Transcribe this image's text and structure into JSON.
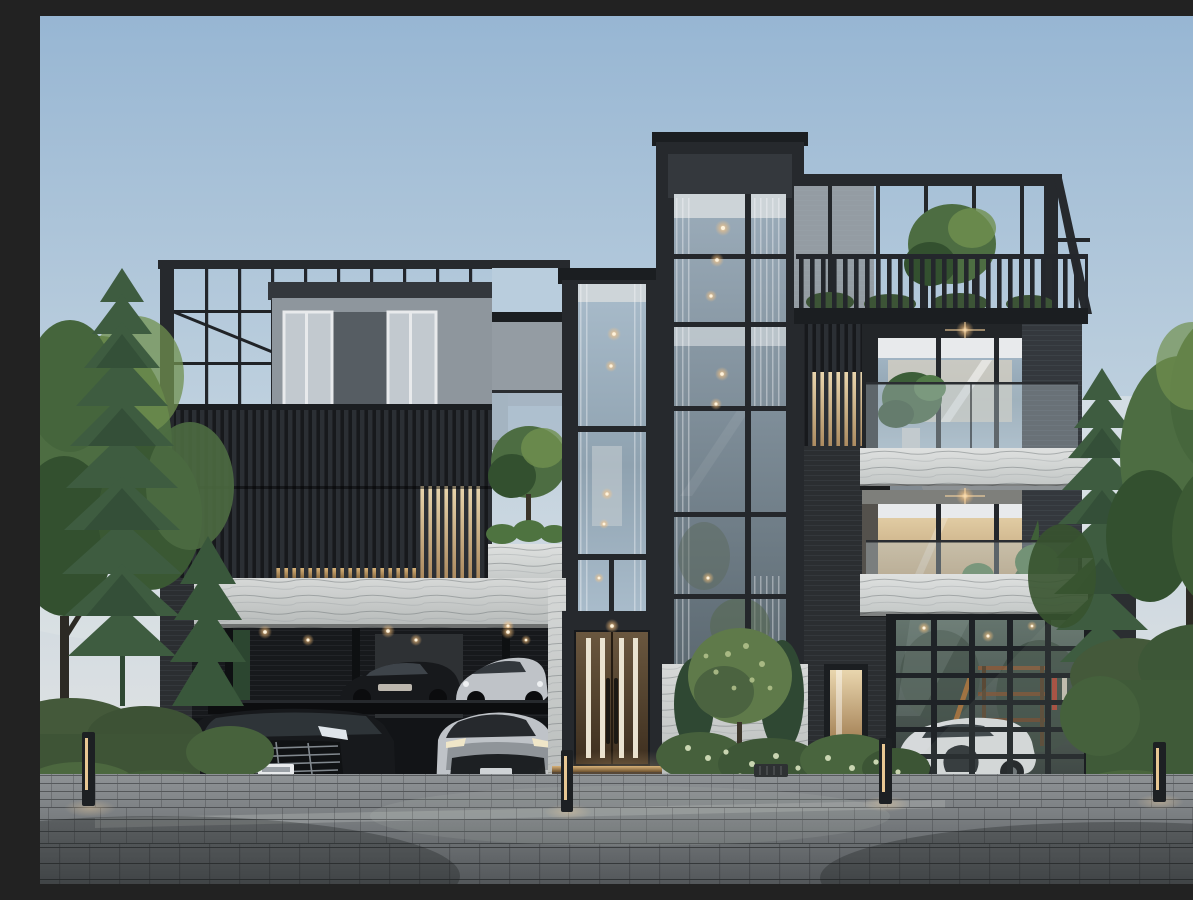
{
  "scene": {
    "type": "photorealistic architectural exterior rendering",
    "subject": "modern four-storey luxury residence at dusk",
    "time_of_day": "dusk",
    "description": "Dusk rendering of a modern charcoal and white-stone luxury townhouse: vertical-louver screen facade with rooftop railing terrace over a grey penthouse volume, a full-height glazed stair tower with warm recessed lights, a rooftop pergola terrace with tree and picket railing, two recessed balconies with glass balustrades, marble parapets and potted plants, a two-level car-lift carport holding four luxury vehicles, a glass sectional garage door revealing a white supercar, a timber double entry door with lit stone steps, clipped hedges, pines and flowering shrubs, warm bollard lights and a grey block-paved driveway."
  },
  "palette": {
    "sky_top": "#97b6d3",
    "sky_mid": "#bed0de",
    "sky_low": "#dadfe2",
    "sky_haze": "#e9ebe9",
    "frame": "#26292d",
    "frame_dark": "#1b1e21",
    "frame_mid": "#34383d",
    "louver_base": "#17191c",
    "louver_bar": "#2b2f34",
    "penthouse": "#8e969d",
    "penthouse_dark": "#565d63",
    "wall_gray": "#949ca3",
    "glass_cool": "#a9bccb",
    "glass_mid": "#8fa2b0",
    "glass_dark": "#5d6a72",
    "interior_warm": "#d9c7a4",
    "interior_white": "#e8eaec",
    "stone": "#d7d9d8",
    "stone_dark": "#b6bab9",
    "marble": "#dfe1e0",
    "wood_lit": "#c8a26b",
    "wood": "#8a6a45",
    "door_wood": "#54412e",
    "door_stripe": "#eae3d1",
    "warm": "#ffca8e",
    "warm_core": "#fff3dc",
    "brick": "#2b2e31",
    "concrete": "#7e7f7b",
    "foliage": "#4d6d42",
    "foliage_dark": "#33502f",
    "foliage_light": "#70904f",
    "conifer": "#3e5c40",
    "conifer_dark": "#2f4833",
    "hedge": "#44593a",
    "flower": "#d9e3bf",
    "paver": "#7c8083",
    "paver_dark": "#53575a",
    "paver_light": "#8f9396",
    "car_black": "#17191c",
    "car_silver": "#bfc3c8",
    "car_white": "#d6d9db"
  },
  "inventory": {
    "building": [
      "rooftop railing terrace",
      "grey penthouse volume",
      "vertical louver screen facade",
      "backlit timber louver panels",
      "glass stair tower",
      "full-height glazed tower",
      "rooftop pergola terrace",
      "picket roof railing",
      "recessed balcony upper",
      "recessed balcony lower",
      "glass balustrades",
      "marble parapets",
      "white stone bands",
      "timber double entry door",
      "lit entry steps",
      "glass sectional garage door",
      "two-level car-lift carport",
      "dark brick service wall with lit window"
    ],
    "vehicles": [
      "black luxury minivan",
      "silver performance SUV",
      "black sports car on upper lift",
      "silver coupe on upper lift",
      "white supercar inside garage"
    ],
    "landscape": [
      "left deciduous trees",
      "norfolk pines left and right",
      "clipped hedges",
      "white flowering shrubs",
      "entry garden tree and cypress shrubs",
      "rooftop terrace tree",
      "balcony monstera and palms"
    ],
    "lighting": [
      "recessed warm downlights",
      "balcony ceiling star lights",
      "four bollard path lights",
      "interior glow in towers and garage"
    ],
    "ground": [
      "grey block-paved driveway",
      "stone kerb",
      "drain grate"
    ]
  },
  "counts": {
    "visible_vehicles": 5,
    "bollard_lights": 4,
    "balconies": 2,
    "roof_terraces": 2
  }
}
